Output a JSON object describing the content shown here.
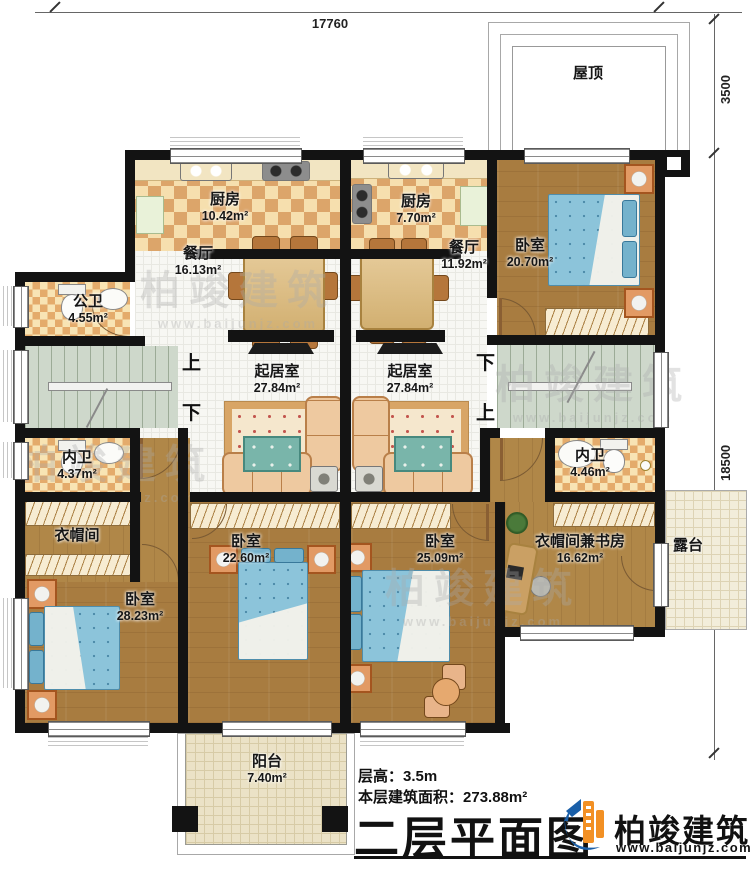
{
  "annotations": {
    "dim_top": "17760",
    "dim_roof": "3500",
    "dim_right": "18500"
  },
  "rooms": {
    "roof": {
      "label": "屋顶",
      "area": ""
    },
    "kitchen_left": {
      "label": "厨房",
      "area": "10.42m²"
    },
    "kitchen_right": {
      "label": "厨房",
      "area": "7.70m²"
    },
    "dining_left": {
      "label": "餐厅",
      "area": "16.13m²"
    },
    "dining_right": {
      "label": "餐厅",
      "area": "11.92m²"
    },
    "bedroom_ne": {
      "label": "卧室",
      "area": "20.70m²"
    },
    "public_bath": {
      "label": "公卫",
      "area": "4.55m²"
    },
    "living_left": {
      "label": "起居室",
      "area": "27.84m²"
    },
    "living_right": {
      "label": "起居室",
      "area": "27.84m²"
    },
    "inner_bath_left": {
      "label": "内卫",
      "area": "4.37m²"
    },
    "inner_bath_right": {
      "label": "内卫",
      "area": "4.46m²"
    },
    "cloakroom": {
      "label": "衣帽间",
      "area": ""
    },
    "bedroom_sw": {
      "label": "卧室",
      "area": "28.23m²"
    },
    "bedroom_s1": {
      "label": "卧室",
      "area": "22.60m²"
    },
    "bedroom_s2": {
      "label": "卧室",
      "area": "25.09m²"
    },
    "study": {
      "label": "衣帽间兼书房",
      "area": "16.62m²"
    },
    "terrace": {
      "label": "露台",
      "area": ""
    },
    "balcony": {
      "label": "阳台",
      "area": "7.40m²"
    }
  },
  "stairs": {
    "up": "上",
    "down": "下"
  },
  "watermark": {
    "brand": "柏竣建筑",
    "site": "www.baijunjz.com"
  },
  "footer": {
    "floor_height_label": "层高：",
    "floor_height_value": "3.5m",
    "floor_area_label": "本层建筑面积：",
    "floor_area_value": "273.88m²",
    "title": "二层平面图",
    "brand": "柏竣建筑",
    "website": "www.baijunjz.com"
  },
  "colors": {
    "wall": "#131313",
    "wood_floor": "#a87c40",
    "tile_floor": "#f7f7f3",
    "kitchen_check": "#dca56a",
    "stairs_floor": "#ced8cb",
    "bed_blue": "#8cc4da",
    "sofa_tan": "#eec9a0",
    "logo_blue": "#1a5fa8",
    "logo_orange": "#f29024"
  }
}
